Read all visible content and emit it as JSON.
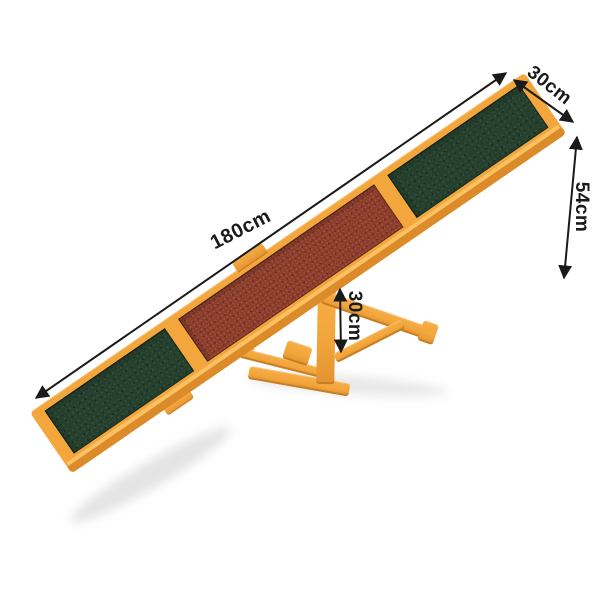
{
  "scene": {
    "description": "Wooden pet agility seesaw product photo with dimension annotations",
    "background": "#FFFFFF"
  },
  "colors": {
    "wood": "#F2A63C",
    "wood_light": "#FFC468",
    "wood_dark": "#DB8B29",
    "panel_green": "#26402E",
    "panel_brown": "#8C3D2B",
    "annotation": "#1A1A1A"
  },
  "dimensions": {
    "length": {
      "label": "180cm"
    },
    "width": {
      "label": "30cm"
    },
    "end_height": {
      "label": "54cm"
    },
    "pivot_height": {
      "label": "30cm"
    }
  }
}
